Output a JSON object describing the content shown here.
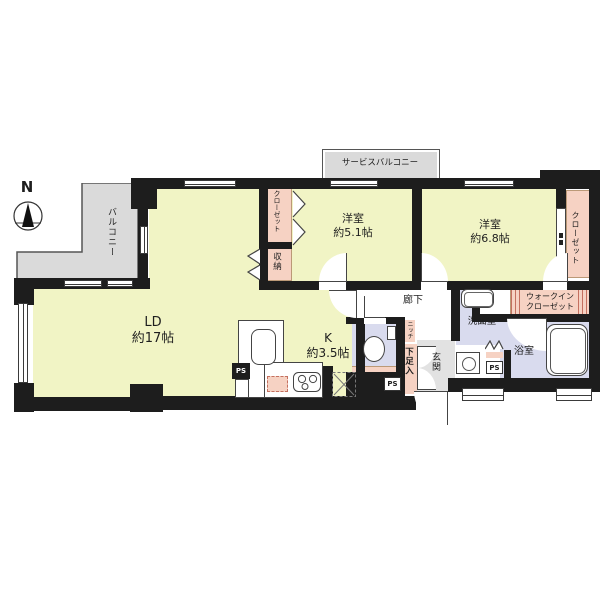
{
  "compass": {
    "label": "N"
  },
  "colors": {
    "room_yellow": "#f1f4c5",
    "closet_pink": "#f6d2c3",
    "wet_area_lavender": "#d9dbee",
    "outdoor_gray": "#dadada",
    "wall_black": "#1d1d1d"
  },
  "labels": {
    "service_balcony": "サービスバルコニー",
    "balcony": "バルコニー",
    "living_dining": {
      "name": "LD",
      "size": "約17帖"
    },
    "kitchen": {
      "name": "K",
      "size": "約3.5帖"
    },
    "bedroom_small": {
      "name": "洋室",
      "size": "約5.1帖"
    },
    "bedroom_large": {
      "name": "洋室",
      "size": "約6.8帖"
    },
    "closet_bedroom_small": "クローゼット",
    "closet_bedroom_large": "クローゼット",
    "storage": "収納",
    "walk_in_closet_line1": "ウォークイン",
    "walk_in_closet_line2": "クローゼット",
    "corridor": "廊下",
    "niche": "ニッチ",
    "shoe_cabinet": "下足入",
    "entrance": "玄関",
    "washroom": "洗面室",
    "bathroom": "浴室",
    "ps": "PS"
  }
}
